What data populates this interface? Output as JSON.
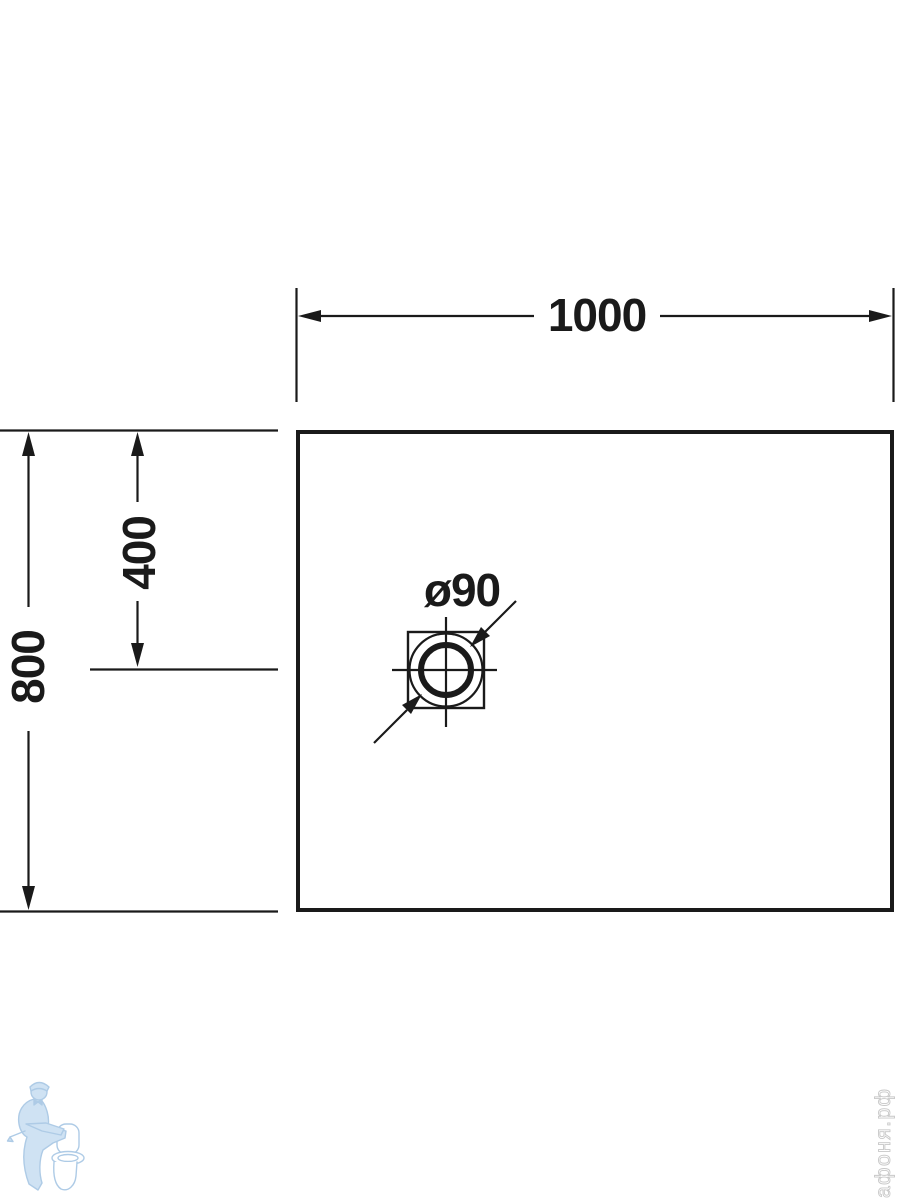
{
  "drawing": {
    "type": "technical-dimension-drawing",
    "subject": "rectangular shower tray plan view with drain",
    "dimensions": {
      "width_mm": "1000",
      "height_mm": "800",
      "drain_offset_from_top_mm": "400",
      "drain_diameter": "ø90"
    },
    "colors": {
      "line": "#1a1a1a",
      "background": "#ffffff",
      "watermark_blue_stroke": "#aecbe6",
      "watermark_blue_fill": "#d6e6f4",
      "watermark_gray": "#c8c8c8"
    },
    "watermark": {
      "logo": "plumber-with-toilet",
      "site_text": "афоня.рф"
    }
  }
}
